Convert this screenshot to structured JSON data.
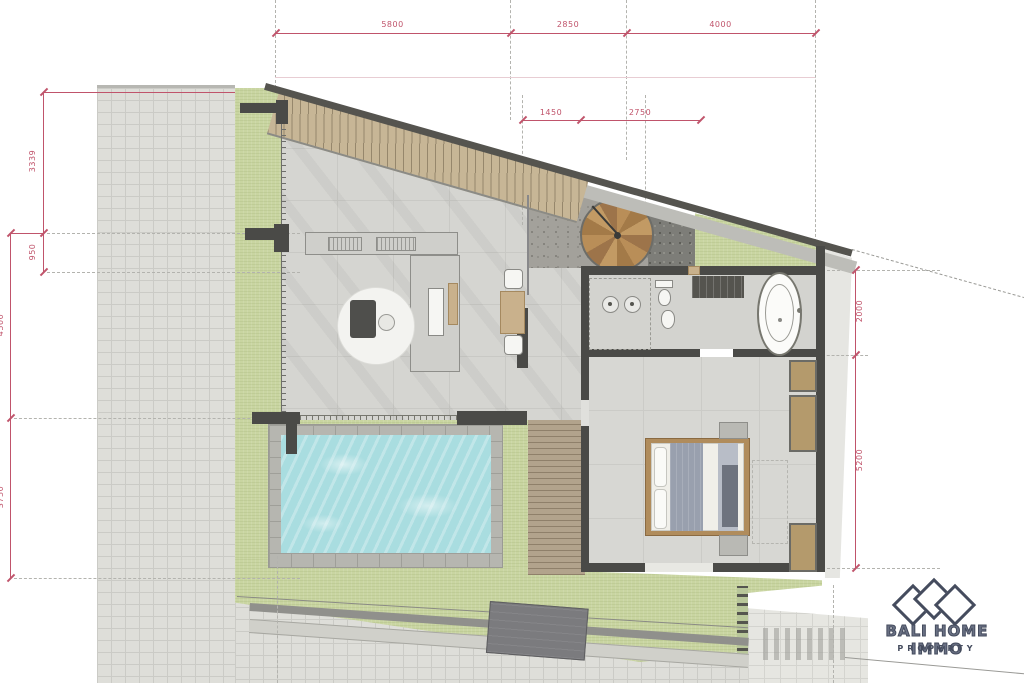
{
  "plan": {
    "dimensions": {
      "top": [
        "5800",
        "2850",
        "4000"
      ],
      "upper_mid": [
        "1450",
        "2750"
      ],
      "left_inner": [
        "3339",
        "950"
      ],
      "left_outer": [
        "4500",
        "3750"
      ],
      "right_side": [
        "2000",
        "5200"
      ]
    },
    "colors": {
      "dimension_pink": "#c0546b",
      "wall_dark": "#4a4a47",
      "grass_green": "#c9d5a1",
      "pool_water": "#a9dde0",
      "wood_tan": "#b58a54",
      "paver_gray": "#dedeD9",
      "logo_navy": "#454c5e"
    }
  },
  "logo": {
    "brand": "BALI HOME IMMO",
    "tagline": "PROPERTY"
  }
}
